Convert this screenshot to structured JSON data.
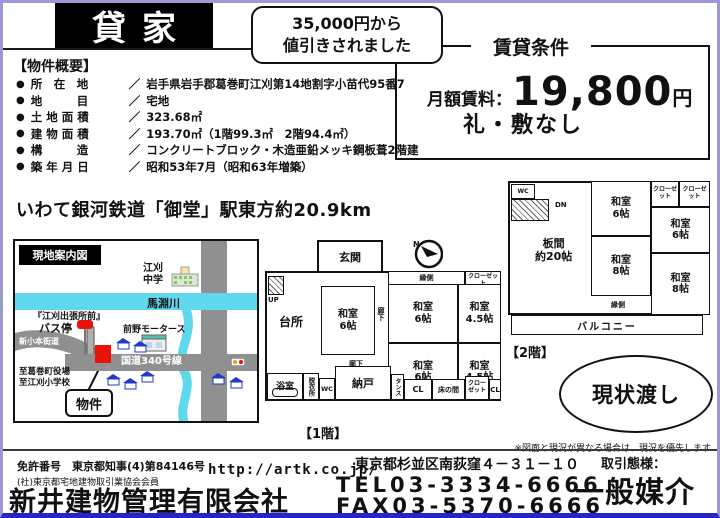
{
  "header": {
    "title": "貸家",
    "discount_line1": "35,000円から",
    "discount_line2": "値引きされました"
  },
  "conditions": {
    "title": "賃貸条件",
    "rent_label": "月額賃料：",
    "rent_amount": "19,800",
    "rent_unit": "円",
    "no_deposit": "礼・敷なし"
  },
  "overview": {
    "heading": "【物件概要】",
    "bullet": "●",
    "separator": "／",
    "items": [
      {
        "label": "所　在　地",
        "value": "岩手県岩手郡葛巻町江刈第14地割字小苗代95番7"
      },
      {
        "label": "地　　　目",
        "value": "宅地"
      },
      {
        "label": "土 地 面 積",
        "value": "323.68㎡"
      },
      {
        "label": "建 物 面 積",
        "value": "193.70㎡（1階99.3㎡　2階94.4㎡）"
      },
      {
        "label": "構　　　造",
        "value": "コンクリートブロック・木造亜鉛メッキ鋼板葺2階建"
      },
      {
        "label": "築 年 月 日",
        "value": "昭和53年7月（昭和63年増築）"
      }
    ]
  },
  "access": {
    "text": "いわて銀河鉄道「御堂」駅東方約20.9km"
  },
  "map": {
    "title": "現地案内図",
    "school_line1": "江刈",
    "school_line2": "中学",
    "river": "馬淵川",
    "bus_stop_line1": "『江刈出張所前』",
    "bus_stop_line2": "バス停",
    "motors": "前野モータース",
    "route": "国道340号線",
    "old_road": "新小本街道",
    "to_office": "至葛巻町役場",
    "to_school": "至江刈小学校",
    "property": "物件"
  },
  "compass": {
    "north": "N"
  },
  "floor1": {
    "caption": "【1階】",
    "genkan": "玄関",
    "kitchen": "台所",
    "up_label": "UP",
    "engawa": "縁側",
    "corridor_v": "廊下",
    "corridor_h": "廊下",
    "closet_tr": "クローゼット",
    "bath": "浴室",
    "dressing": "脱衣所",
    "wc": "WC",
    "storage": "納戸",
    "tansu": "タンス",
    "cl1": "CL",
    "tokonoma": "床の間",
    "closet_b": "クローゼット",
    "cl2": "CL",
    "rooms": [
      {
        "name": "和室",
        "size": "6帖"
      },
      {
        "name": "和室",
        "size": "6帖"
      },
      {
        "name": "和室",
        "size": "4.5帖"
      },
      {
        "name": "和室",
        "size": "6帖"
      },
      {
        "name": "和室",
        "size": "4.5帖"
      }
    ]
  },
  "floor2": {
    "caption": "【2階】",
    "wc": "WC",
    "dn_label": "DN",
    "itanoma_name": "板間",
    "itanoma_size": "約20帖",
    "closet1": "クローゼット",
    "closet2": "クローゼット",
    "engawa": "縁側",
    "balcony": "バルコニー",
    "rooms": [
      {
        "name": "和室",
        "size": "6帖"
      },
      {
        "name": "和室",
        "size": "6帖"
      },
      {
        "name": "和室",
        "size": "8帖"
      },
      {
        "name": "和室",
        "size": "8帖"
      }
    ]
  },
  "asis": {
    "text": "現状渡し"
  },
  "note": {
    "text": "※図面と現況が異なる場合は、現況を優先します"
  },
  "footer": {
    "license_no": "免許番号　東京都知事(4)第84146号",
    "association": "(社)東京都宅地建物取引業協会会員",
    "company": "新井建物管理有限会社",
    "url": "http://artk.co.jp/",
    "address": "東京都杉並区南荻窪４－３１－１０",
    "tel": "TEL03-3334-6666",
    "fax": "FAX03-5370-6666",
    "deal_label": "取引態様：",
    "deal_type": "一般媒介"
  },
  "colors": {
    "title_bg": "#000000",
    "page_border_purple": "#9a9ad0",
    "bottom_border_blue": "#2525d0",
    "river_cyan": "#5fd8ee",
    "road_gray": "#909090",
    "marker_red": "#e8140c",
    "house_blue": "#2138c8"
  }
}
